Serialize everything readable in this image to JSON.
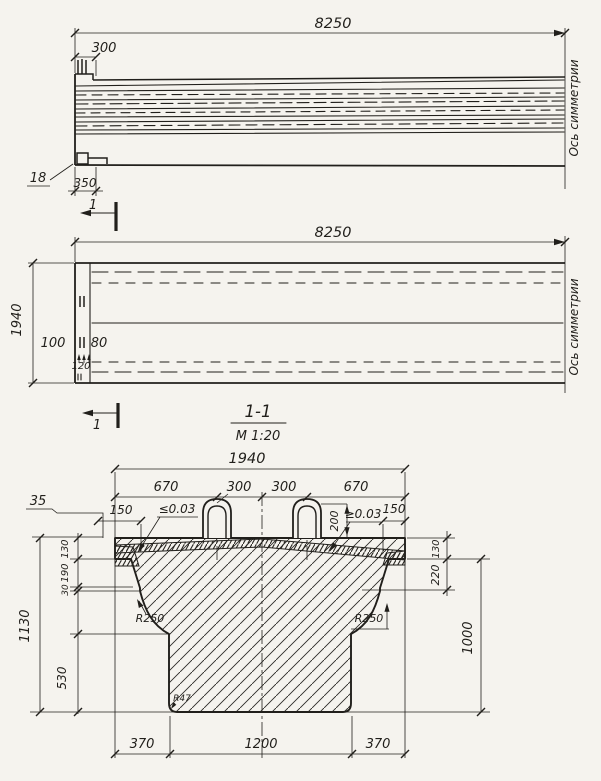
{
  "palette": {
    "paper": "#f5f3ee",
    "ink": "#211f1b"
  },
  "elevation": {
    "dim_span": "8250",
    "dim_end_offset": "300",
    "plate_mark": "18",
    "dim_plate": "350",
    "section_mark": "1",
    "axis_label": "Ось симметрии"
  },
  "plan": {
    "dim_span": "8250",
    "dim_width": "1940",
    "dim_100": "100",
    "dim_80": "80",
    "dim_120": "120",
    "section_mark": "1",
    "axis_label": "Ось симметрии"
  },
  "section": {
    "title": "1-1",
    "scale": "М 1:20",
    "dim_width": "1940",
    "dim_670_left": "670",
    "dim_300_left": "300",
    "dim_300_right": "300",
    "dim_670_right": "670",
    "dim_35": "35",
    "dim_150_left": "150",
    "slope_left": "≤0.03",
    "dim_200": "200",
    "slope_right": "≥0.03",
    "dim_150_right": "150",
    "dim_130_left": "130",
    "dim_190": "190",
    "dim_30": "30",
    "dim_530": "530",
    "dim_1130": "1130",
    "dim_130_right": "130",
    "dim_220": "220",
    "dim_1000": "1000",
    "radius_left": "R250",
    "radius_right": "R250",
    "radius_corner": "R47",
    "dim_370_left": "370",
    "dim_1200": "1200",
    "dim_370_right": "370"
  }
}
